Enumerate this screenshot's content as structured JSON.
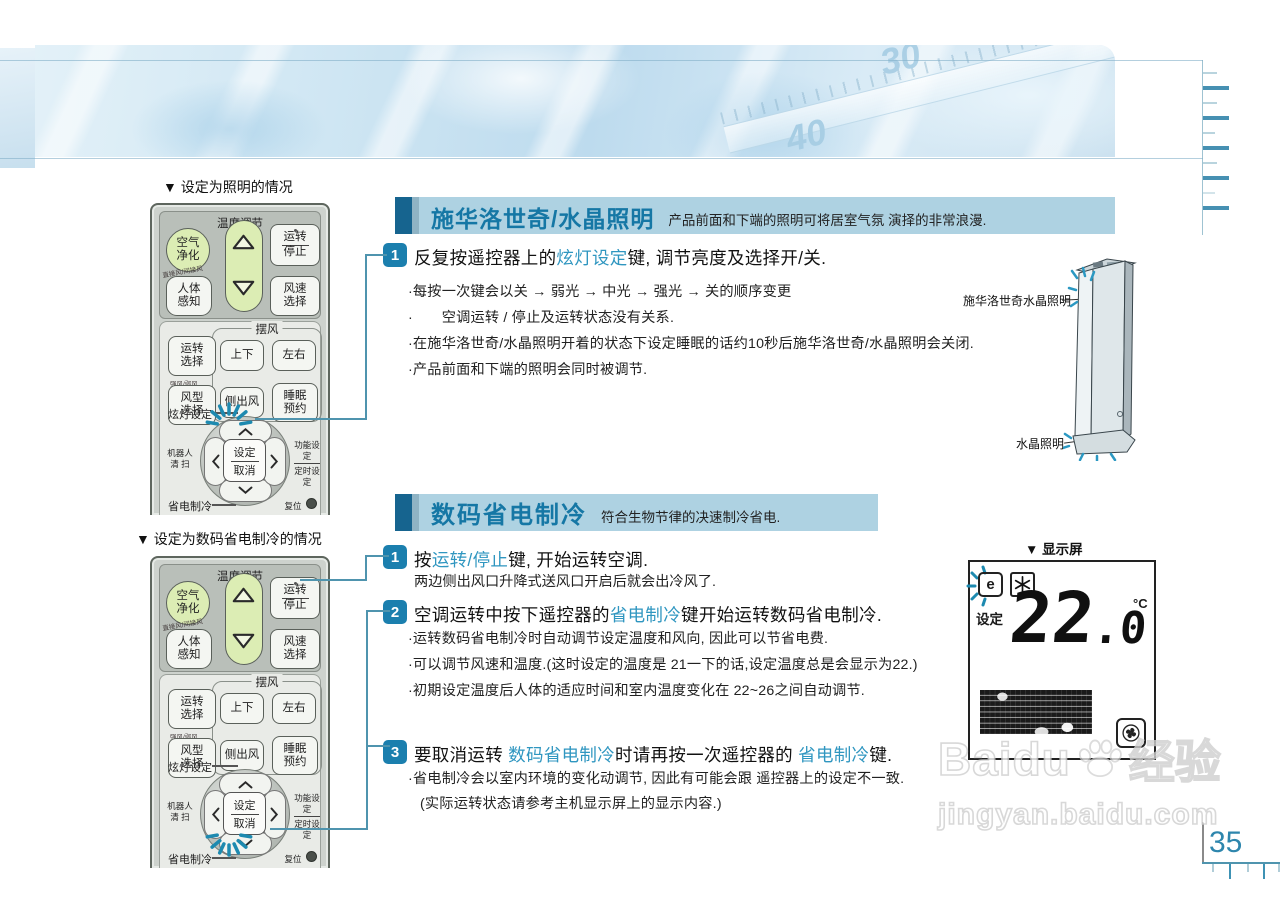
{
  "colors": {
    "accent_blue": "#2f96c0",
    "title_blue": "#1577a5",
    "header_bar": "#aed2e2",
    "header_block": "#16648f",
    "step_badge": "#1b7fae",
    "tick_dark": "#4690b2",
    "tick_light": "#b9d4de",
    "page_number": "#2e86ad",
    "callout_line": "#4f94ae",
    "burst_blue": "#1d8ab0"
  },
  "icons": {
    "burst": "sparkle-dashes",
    "snowflake": "snowflake-asterisk",
    "fan": "fan-blades",
    "paw": "baidu-paw",
    "triangle_up": "▲",
    "triangle_down": "▼",
    "chevron": "⌃",
    "led_dot": "•",
    "reset_dot": "●"
  },
  "banner": {
    "thermo_30": "30",
    "thermo_40": "40",
    "thermo_unit": "°C"
  },
  "left": {
    "caption1": "▼ 设定为照明的情况",
    "caption2": "▼ 设定为数码省电制冷的情况"
  },
  "remote": {
    "temp_title": "温度调节",
    "air_clean": "空气净化",
    "run": "运转",
    "stop": "停止",
    "direct_wind": "直接风/间接风",
    "body_sense": "人体感知",
    "fan_speed": "风速选择",
    "swing": "摆风",
    "run_select": "运转选择",
    "updown": "上下",
    "leftright": "左右",
    "wind_type_small": "强风/弱风",
    "wind_type": "风型选择",
    "side_wind": "侧出风",
    "sleep": "睡眠预约",
    "light_set": "炫灯设定",
    "set": "设定",
    "cancel": "取消",
    "robot1": "机器人",
    "robot2": "清 扫",
    "func_set": "功能设定",
    "timer_set": "定时设定",
    "save_cool": "省电制冷",
    "reset": "复位"
  },
  "section1": {
    "step_no": "1",
    "title": "施华洛世奇/水晶照明",
    "subtitle": "产品前面和下端的照明可将居室气氛 演择的非常浪漫.",
    "step1": [
      {
        "t": "反复按遥控器上的"
      },
      {
        "t": "炫灯设定",
        "hl": true
      },
      {
        "t": "键, 调节亮度及选择开/关."
      }
    ],
    "bullets": [
      "·每按一次键会以关 → 弱光 → 中光 → 强光 → 关的顺序变更",
      "·　　空调运转 / 停止及运转状态没有关系.",
      "·在施华洛世奇/水晶照明开着的状态下设定睡眠的话约10秒后施华洛世奇/水晶照明会关闭.",
      "·产品前面和下端的照明会同时被调节."
    ],
    "tower_label_top": "施华洛世奇水晶照明",
    "tower_label_bottom": "水晶照明"
  },
  "section2": {
    "title": "数码省电制冷",
    "subtitle": "符合生物节律的决速制冷省电.",
    "display_caption": "▼ 显示屏",
    "step1_no": "1",
    "step2_no": "2",
    "step3_no": "3",
    "step1": [
      {
        "t": "按"
      },
      {
        "t": "运转/停止",
        "hl": true
      },
      {
        "t": "键, 开始运转空调."
      }
    ],
    "step1_sub": "两边侧出风口升降式送风口开启后就会出冷风了.",
    "step2": [
      {
        "t": "空调运转中按下遥控器的"
      },
      {
        "t": "省电制冷",
        "hl": true
      },
      {
        "t": "键开始运转数码省电制冷."
      }
    ],
    "step2_bullets": [
      "·运转数码省电制冷时自动调节设定温度和风向, 因此可以节省电费.",
      "·可以调节风速和温度.(这时设定的温度是 21一下的话,设定温度总是会显示为22.)",
      "·初期设定温度后人体的适应时间和室内温度变化在 22~26之间自动调节."
    ],
    "step3": [
      {
        "t": "要取消运转 "
      },
      {
        "t": "数码省电制冷",
        "hl": true
      },
      {
        "t": "时请再按一次遥控器的 "
      },
      {
        "t": "省电制冷",
        "hl": true
      },
      {
        "t": "键."
      }
    ],
    "step3_bullets": [
      "·省电制冷会以室内环境的变化动调节, 因此有可能会跟 遥控器上的设定不一致.",
      "(实际运转状态请参考主机显示屏上的显示内容.)"
    ],
    "display": {
      "set_label": "设定",
      "temp_int": "22",
      "temp_dot": ".",
      "temp_dec": "0",
      "unit": "°C",
      "e_icon": "e"
    }
  },
  "watermark": {
    "brand": "Baidu",
    "brand_cn": "经验",
    "url": "jingyan.baidu.com"
  },
  "page": {
    "number": "35"
  }
}
